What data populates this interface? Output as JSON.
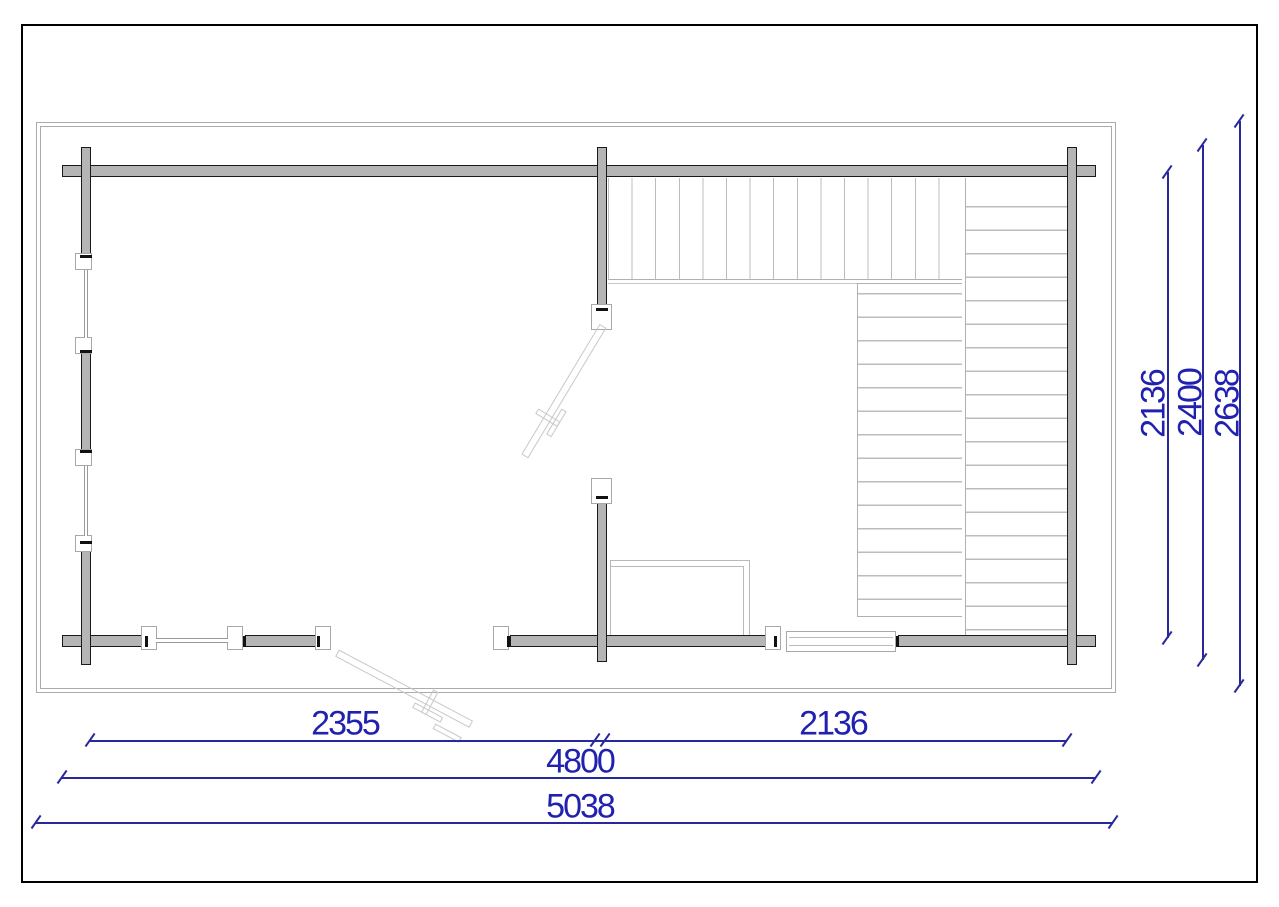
{
  "drawing": {
    "type": "floor-plan",
    "labels": {
      "dim_2355": "2355",
      "dim_2136_bottom": "2136",
      "dim_4800": "4800",
      "dim_5038": "5038",
      "dim_2136_right": "2136",
      "dim_2400_right": "2400",
      "dim_2638_right": "2638"
    },
    "colors": {
      "dimension_blue": "#2121b0",
      "wall_gray": "#b5b5b5",
      "outline_black": "#1a1a1a",
      "frame_gray": "#ababab",
      "plank_gray": "#bcbcbc",
      "thin_outline_gray": "#c8c8c8"
    }
  }
}
